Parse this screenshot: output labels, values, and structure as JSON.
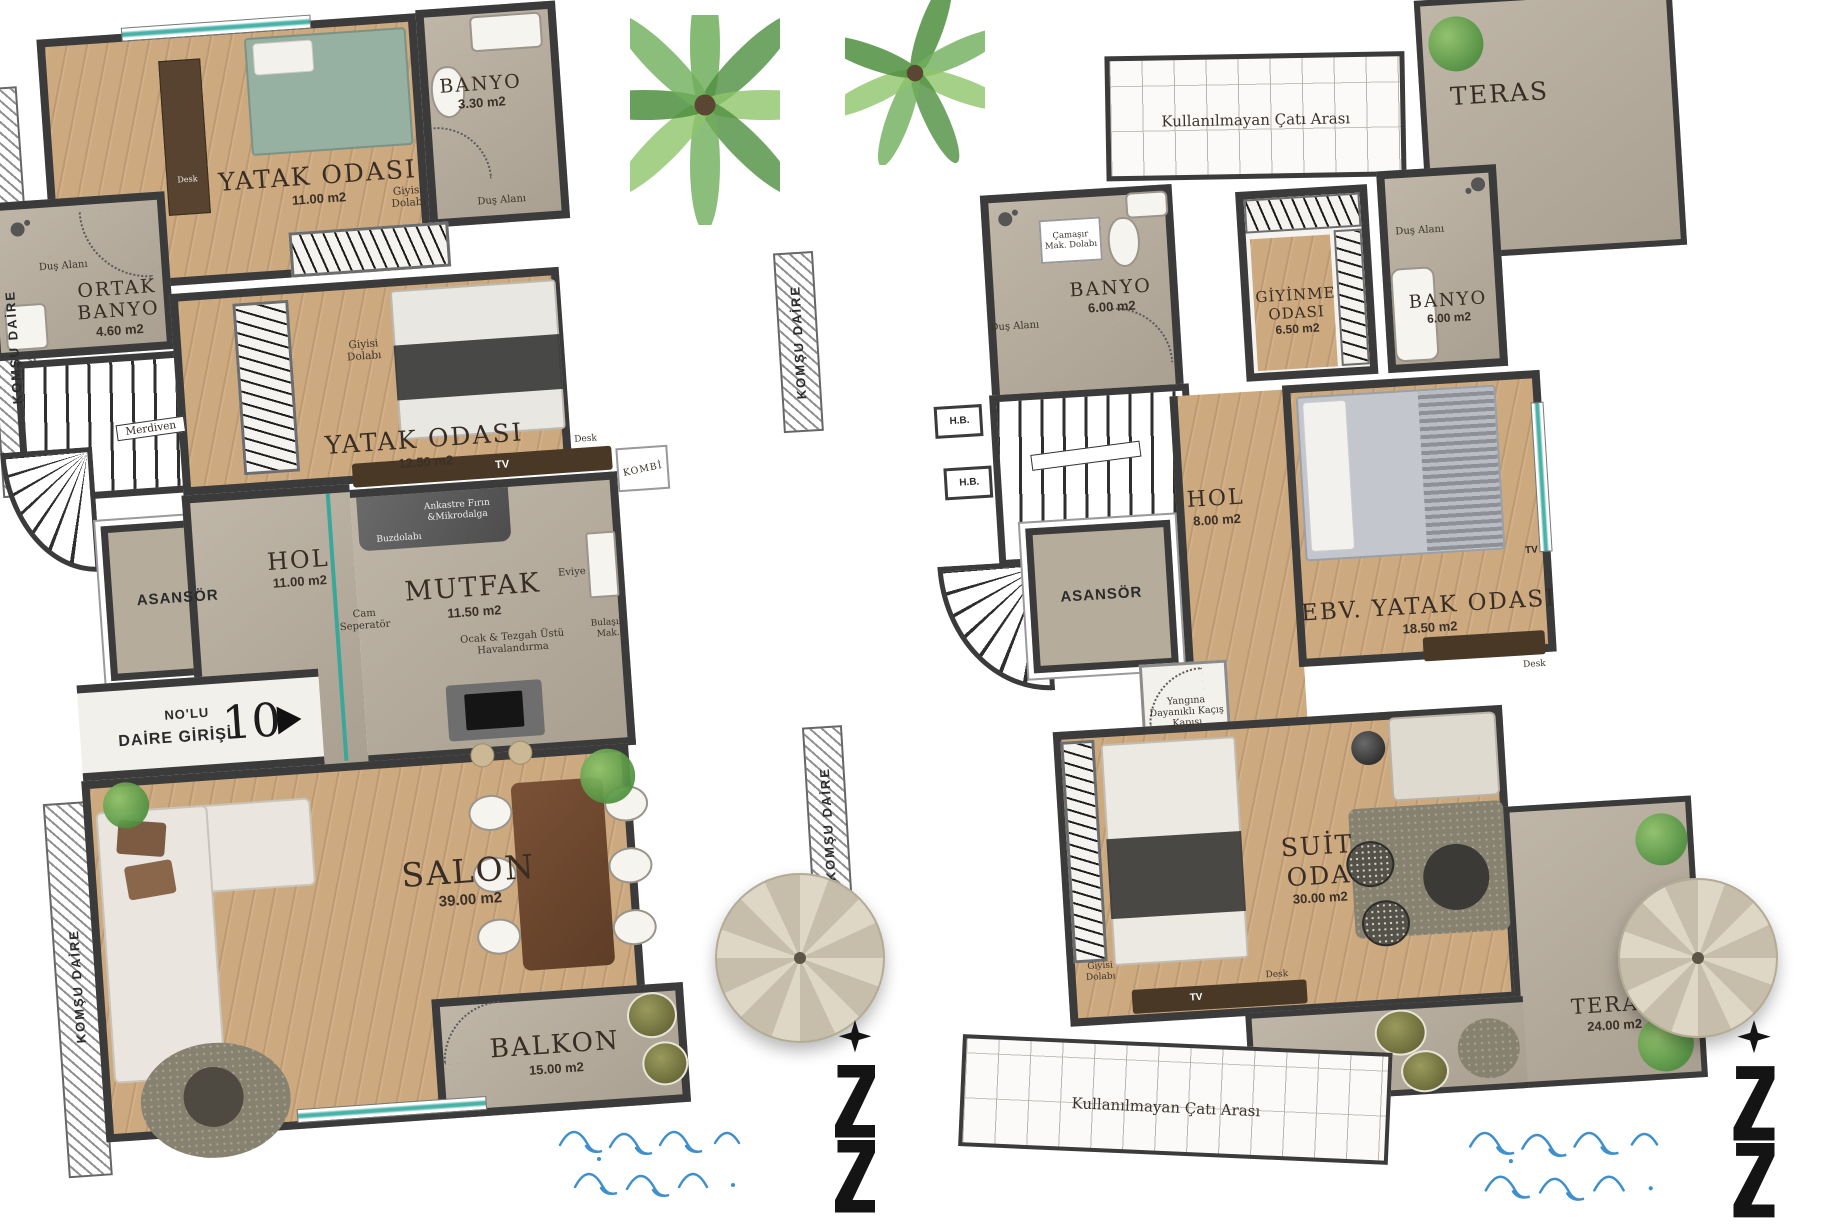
{
  "colors": {
    "wall": "#3b3b3b",
    "wood_floor": "#cda97f",
    "stone_floor": "#b6ac9c",
    "window_teal": "#49b2a8",
    "wave_blue": "#3f8fcc",
    "plant_green": "#4e8f3e",
    "bed_green": "#96b0a2"
  },
  "left_plan": {
    "komsu_top": "KOMŞU DAİRE",
    "komsu_bottom": "KOMŞU DAİRE",
    "bedroom1": {
      "name": "YATAK ODASI",
      "area": "11.00 m2",
      "desk": "Desk",
      "closet": "Giyisi Dolabı"
    },
    "banyo1": {
      "name": "BANYO",
      "area": "3.30 m2",
      "shower": "Duş Alanı"
    },
    "ortak_banyo": {
      "name": "ORTAK BANYO",
      "area": "4.60 m2",
      "shower": "Duş Alanı"
    },
    "bedroom2": {
      "name": "YATAK ODASI",
      "area": "12.50 m2",
      "closet": "Giyisi Dolabı"
    },
    "stairs_label": "Merdiven",
    "asansor": "ASANSÖR",
    "hol": {
      "name": "HOL",
      "area": "11.00 m2"
    },
    "mutfak": {
      "name": "MUTFAK",
      "area": "11.50 m2",
      "oven": "Ankastre Fırın &Mikrodalga",
      "fridge": "Buzdolabı",
      "separator": "Cam Seperatör",
      "sink": "Eviye",
      "dishwasher": "Bulaşık Mak.",
      "hood": "Ocak & Tezgah Üstü Havalandırma"
    },
    "kombi": "KOMBİ",
    "tv_unit": {
      "tv": "TV",
      "desk": "Desk"
    },
    "entrance": {
      "line1": "NO'LU",
      "line2": "DAİRE GİRİŞİ",
      "number": "10"
    },
    "salon": {
      "name": "SALON",
      "area": "39.00 m2"
    },
    "balkon": {
      "name": "BALKON",
      "area": "15.00 m2"
    }
  },
  "right_plan": {
    "komsu_top": "KOMŞU DAİRE",
    "komsu_bottom": "KOMŞU DAİRE",
    "teras_top": "TERAS",
    "cati_top": "Kullanılmayan Çatı Arası",
    "cati_bottom": "Kullanılmayan Çatı Arası",
    "banyo1": {
      "name": "BANYO",
      "area": "6.00 m2",
      "laundry": "Çamaşır Mak. Dolabı",
      "shower": "Duş Alanı"
    },
    "giyinme": {
      "name": "GİYİNME ODASI",
      "area": "6.50 m2"
    },
    "banyo2": {
      "name": "BANYO",
      "area": "6.00 m2",
      "shower": "Duş Alanı"
    },
    "hb1": "H.B.",
    "hb2": "H.B.",
    "hol": {
      "name": "HOL",
      "area": "8.00 m2"
    },
    "asansor": "ASANSÖR",
    "ebv": {
      "name": "EBV. YATAK ODASI",
      "area": "18.50 m2",
      "tv": "TV",
      "desk": "Desk"
    },
    "fire_exit": "Yangına Dayanıklı Kaçış Kapısı",
    "suit": {
      "name1": "SUİT",
      "name2": "ODA",
      "area": "30.00 m2",
      "closet": "Giyisi Dolabı",
      "tv": "TV",
      "desk": "Desk"
    },
    "teras_bottom": {
      "name": "TERAS",
      "area": "24.00 m2"
    }
  }
}
